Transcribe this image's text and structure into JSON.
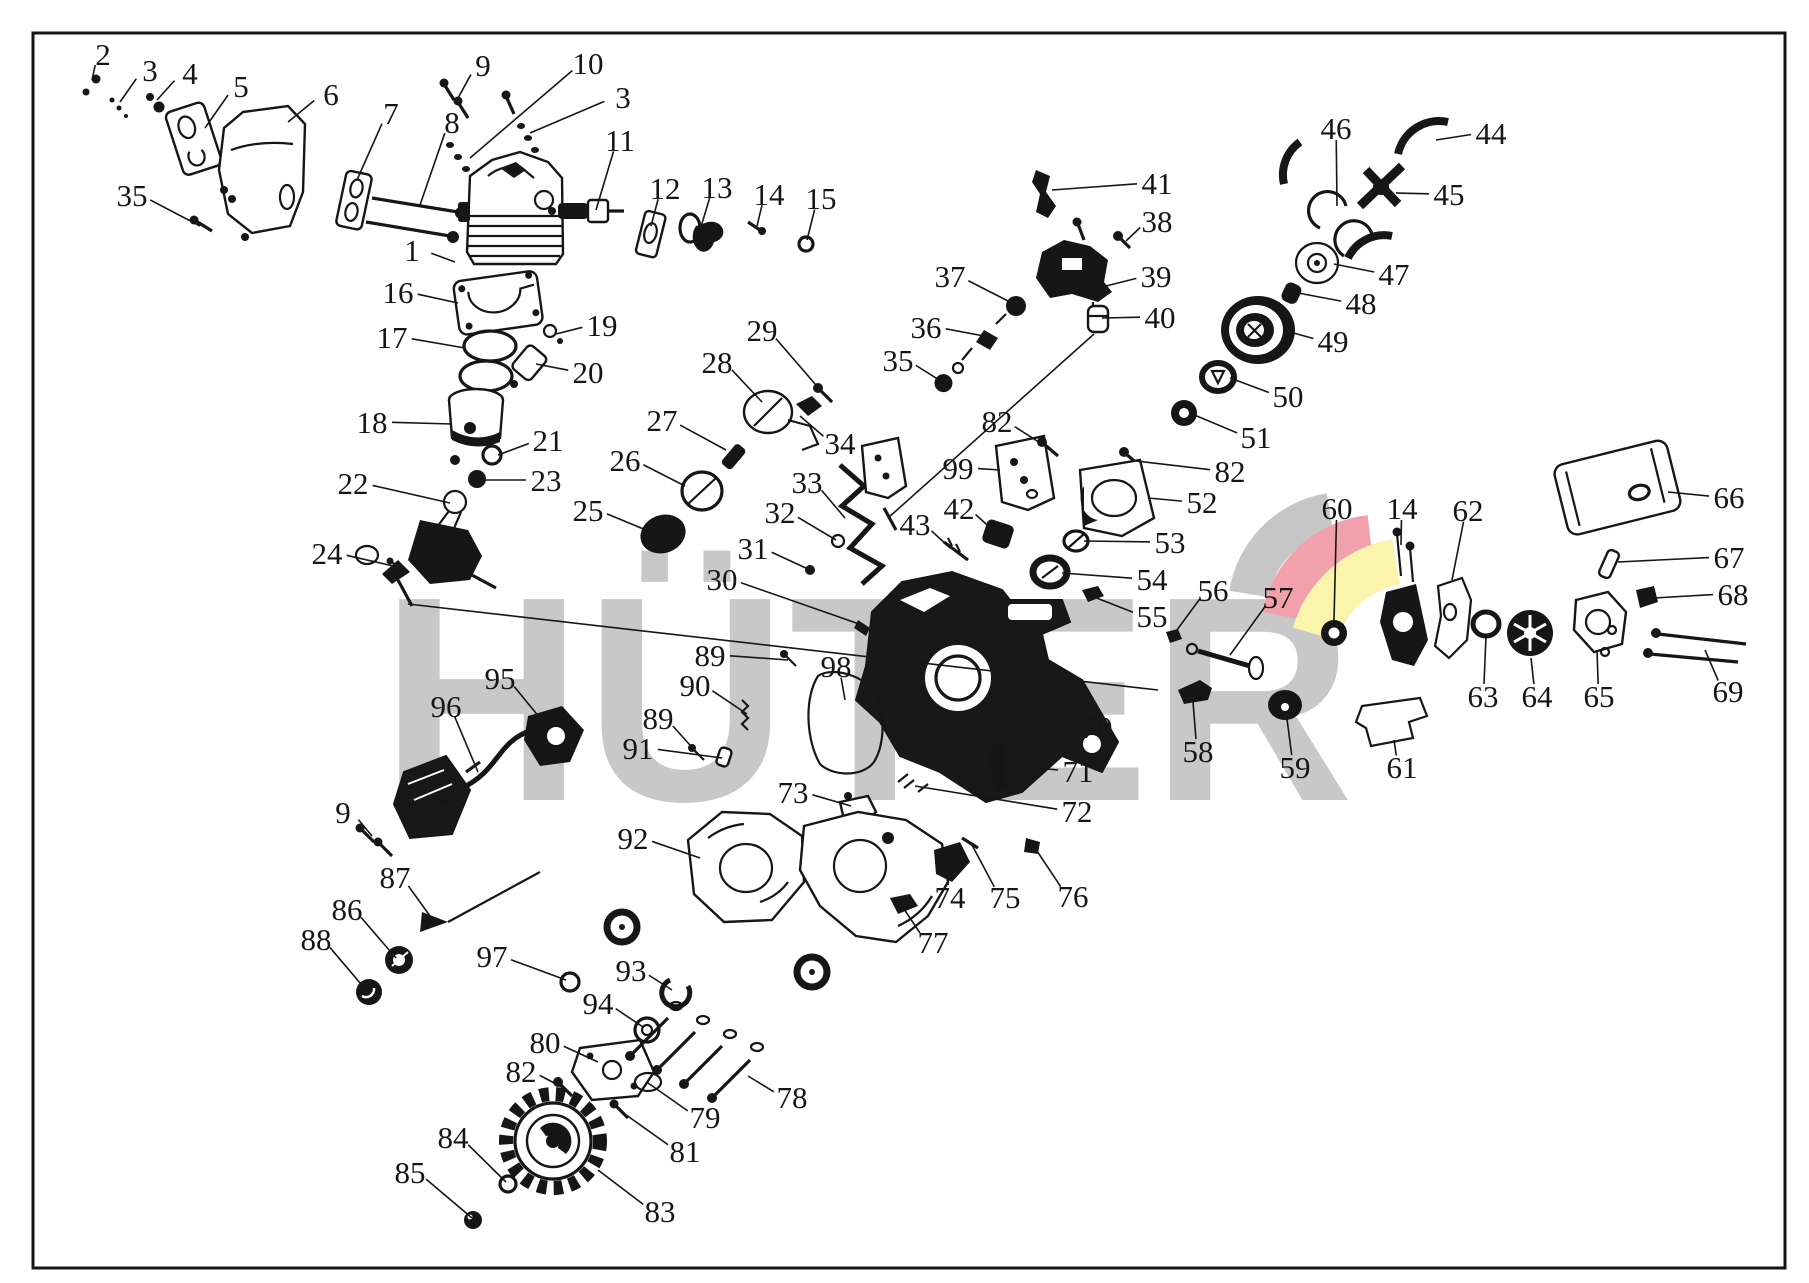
{
  "title": "chainsaw-exploded-parts-diagram",
  "watermark": {
    "text": "HÜTER"
  },
  "colors": {
    "ink": "#161616",
    "watermark_gray": "#c8c8c8",
    "logo_gray": "#c6c6c6",
    "logo_pink": "#f2a0ac",
    "logo_yellow": "#faf4ac",
    "background": "#ffffff"
  },
  "callouts": [
    {
      "n": "2",
      "x": 103,
      "y": 54,
      "tx": 92,
      "ty": 80
    },
    {
      "n": "3",
      "x": 150,
      "y": 70,
      "tx": 120,
      "ty": 102
    },
    {
      "n": "4",
      "x": 190,
      "y": 73,
      "tx": 157,
      "ty": 100
    },
    {
      "n": "5",
      "x": 241,
      "y": 86,
      "tx": 205,
      "ty": 128
    },
    {
      "n": "6",
      "x": 331,
      "y": 94,
      "tx": 288,
      "ty": 122
    },
    {
      "n": "7",
      "x": 391,
      "y": 113,
      "tx": 357,
      "ty": 180
    },
    {
      "n": "8",
      "x": 452,
      "y": 122,
      "tx": 420,
      "ty": 205
    },
    {
      "n": "9",
      "x": 483,
      "y": 65,
      "tx": 458,
      "ty": 98
    },
    {
      "n": "10",
      "x": 588,
      "y": 63,
      "tx": 470,
      "ty": 158
    },
    {
      "n": "3",
      "x": 623,
      "y": 97,
      "tx": 530,
      "ty": 133
    },
    {
      "n": "11",
      "x": 620,
      "y": 140,
      "tx": 596,
      "ty": 210
    },
    {
      "n": "35",
      "x": 132,
      "y": 195,
      "tx": 200,
      "ty": 226
    },
    {
      "n": "12",
      "x": 665,
      "y": 188,
      "tx": 651,
      "ty": 226
    },
    {
      "n": "13",
      "x": 717,
      "y": 187,
      "tx": 700,
      "ty": 230
    },
    {
      "n": "14",
      "x": 769,
      "y": 194,
      "tx": 757,
      "ty": 226
    },
    {
      "n": "15",
      "x": 821,
      "y": 198,
      "tx": 807,
      "ty": 240
    },
    {
      "n": "1",
      "x": 412,
      "y": 250,
      "tx": 455,
      "ty": 262
    },
    {
      "n": "16",
      "x": 398,
      "y": 292,
      "tx": 458,
      "ty": 303
    },
    {
      "n": "17",
      "x": 392,
      "y": 337,
      "tx": 465,
      "ty": 348
    },
    {
      "n": "19",
      "x": 602,
      "y": 325,
      "tx": 556,
      "ty": 334
    },
    {
      "n": "20",
      "x": 588,
      "y": 372,
      "tx": 536,
      "ty": 364
    },
    {
      "n": "18",
      "x": 372,
      "y": 422,
      "tx": 452,
      "ty": 424
    },
    {
      "n": "21",
      "x": 548,
      "y": 440,
      "tx": 498,
      "ty": 455
    },
    {
      "n": "23",
      "x": 546,
      "y": 480,
      "tx": 482,
      "ty": 480
    },
    {
      "n": "22",
      "x": 353,
      "y": 483,
      "tx": 450,
      "ty": 503
    },
    {
      "n": "24",
      "x": 327,
      "y": 553,
      "tx": 393,
      "ty": 566
    },
    {
      "n": "25",
      "x": 588,
      "y": 510,
      "tx": 646,
      "ty": 530
    },
    {
      "n": "26",
      "x": 625,
      "y": 460,
      "tx": 685,
      "ty": 486
    },
    {
      "n": "27",
      "x": 662,
      "y": 420,
      "tx": 726,
      "ty": 450
    },
    {
      "n": "28",
      "x": 717,
      "y": 362,
      "tx": 762,
      "ty": 402
    },
    {
      "n": "29",
      "x": 762,
      "y": 330,
      "tx": 822,
      "ty": 392
    },
    {
      "n": "30",
      "x": 722,
      "y": 579,
      "tx": 862,
      "ty": 625
    },
    {
      "n": "31",
      "x": 753,
      "y": 548,
      "tx": 808,
      "ty": 569
    },
    {
      "n": "32",
      "x": 780,
      "y": 512,
      "tx": 836,
      "ty": 540
    },
    {
      "n": "33",
      "x": 807,
      "y": 482,
      "tx": 845,
      "ty": 518
    },
    {
      "n": "34",
      "x": 840,
      "y": 443,
      "tx": 800,
      "ty": 416
    },
    {
      "n": "41",
      "x": 1157,
      "y": 183,
      "tx": 1052,
      "ty": 190
    },
    {
      "n": "38",
      "x": 1157,
      "y": 221,
      "tx": 1126,
      "ty": 241
    },
    {
      "n": "39",
      "x": 1156,
      "y": 276,
      "tx": 1106,
      "ty": 286
    },
    {
      "n": "40",
      "x": 1160,
      "y": 317,
      "tx": 1102,
      "ty": 318
    },
    {
      "n": "37",
      "x": 950,
      "y": 276,
      "tx": 1010,
      "ty": 302
    },
    {
      "n": "36",
      "x": 926,
      "y": 327,
      "tx": 984,
      "ty": 336
    },
    {
      "n": "35",
      "x": 898,
      "y": 360,
      "tx": 944,
      "ty": 383
    },
    {
      "n": "82",
      "x": 997,
      "y": 421,
      "tx": 1048,
      "ty": 448
    },
    {
      "n": "99",
      "x": 958,
      "y": 468,
      "tx": 1000,
      "ty": 470
    },
    {
      "n": "42",
      "x": 959,
      "y": 508,
      "tx": 995,
      "ty": 532
    },
    {
      "n": "43",
      "x": 915,
      "y": 524,
      "tx": 950,
      "ty": 548
    },
    {
      "n": "46",
      "x": 1336,
      "y": 128,
      "tx": 1337,
      "ty": 206
    },
    {
      "n": "44",
      "x": 1491,
      "y": 133,
      "tx": 1436,
      "ty": 140
    },
    {
      "n": "45",
      "x": 1449,
      "y": 194,
      "tx": 1396,
      "ty": 193
    },
    {
      "n": "47",
      "x": 1394,
      "y": 274,
      "tx": 1334,
      "ty": 264
    },
    {
      "n": "48",
      "x": 1361,
      "y": 303,
      "tx": 1298,
      "ty": 293
    },
    {
      "n": "49",
      "x": 1333,
      "y": 341,
      "tx": 1290,
      "ty": 332
    },
    {
      "n": "50",
      "x": 1288,
      "y": 396,
      "tx": 1230,
      "ty": 378
    },
    {
      "n": "51",
      "x": 1256,
      "y": 437,
      "tx": 1192,
      "ty": 414
    },
    {
      "n": "82",
      "x": 1230,
      "y": 471,
      "tx": 1136,
      "ty": 461
    },
    {
      "n": "52",
      "x": 1202,
      "y": 502,
      "tx": 1148,
      "ty": 498
    },
    {
      "n": "53",
      "x": 1170,
      "y": 542,
      "tx": 1084,
      "ty": 541
    },
    {
      "n": "54",
      "x": 1152,
      "y": 579,
      "tx": 1062,
      "ty": 573
    },
    {
      "n": "55",
      "x": 1152,
      "y": 616,
      "tx": 1094,
      "ty": 597
    },
    {
      "n": "56",
      "x": 1213,
      "y": 590,
      "tx": 1174,
      "ty": 634
    },
    {
      "n": "57",
      "x": 1278,
      "y": 597,
      "tx": 1230,
      "ty": 655
    },
    {
      "n": "60",
      "x": 1337,
      "y": 508,
      "tx": 1334,
      "ty": 620
    },
    {
      "n": "14",
      "x": 1402,
      "y": 508,
      "tx": 1401,
      "ty": 545
    },
    {
      "n": "62",
      "x": 1468,
      "y": 510,
      "tx": 1452,
      "ty": 580
    },
    {
      "n": "66",
      "x": 1729,
      "y": 497,
      "tx": 1668,
      "ty": 492
    },
    {
      "n": "67",
      "x": 1729,
      "y": 557,
      "tx": 1618,
      "ty": 562
    },
    {
      "n": "68",
      "x": 1733,
      "y": 594,
      "tx": 1654,
      "ty": 598
    },
    {
      "n": "69",
      "x": 1728,
      "y": 691,
      "tx": 1705,
      "ty": 650
    },
    {
      "n": "63",
      "x": 1483,
      "y": 696,
      "tx": 1486,
      "ty": 636
    },
    {
      "n": "64",
      "x": 1537,
      "y": 696,
      "tx": 1531,
      "ty": 658
    },
    {
      "n": "65",
      "x": 1599,
      "y": 696,
      "tx": 1597,
      "ty": 650
    },
    {
      "n": "61",
      "x": 1402,
      "y": 767,
      "tx": 1394,
      "ty": 740
    },
    {
      "n": "58",
      "x": 1198,
      "y": 751,
      "tx": 1193,
      "ty": 702
    },
    {
      "n": "59",
      "x": 1295,
      "y": 767,
      "tx": 1287,
      "ty": 719
    },
    {
      "n": "70",
      "x": 1097,
      "y": 727,
      "tx": 1018,
      "ty": 688
    },
    {
      "n": "71",
      "x": 1078,
      "y": 771,
      "tx": 1007,
      "ty": 765
    },
    {
      "n": "72",
      "x": 1077,
      "y": 811,
      "tx": 915,
      "ty": 786
    },
    {
      "n": "73",
      "x": 793,
      "y": 792,
      "tx": 851,
      "ty": 806
    },
    {
      "n": "74",
      "x": 950,
      "y": 897,
      "tx": 947,
      "ty": 864
    },
    {
      "n": "75",
      "x": 1005,
      "y": 897,
      "tx": 972,
      "ty": 845
    },
    {
      "n": "76",
      "x": 1073,
      "y": 896,
      "tx": 1033,
      "ty": 845
    },
    {
      "n": "77",
      "x": 933,
      "y": 942,
      "tx": 902,
      "ty": 906
    },
    {
      "n": "89",
      "x": 710,
      "y": 655,
      "tx": 788,
      "ty": 660
    },
    {
      "n": "90",
      "x": 695,
      "y": 685,
      "tx": 747,
      "ty": 714
    },
    {
      "n": "89",
      "x": 658,
      "y": 718,
      "tx": 698,
      "ty": 754
    },
    {
      "n": "91",
      "x": 638,
      "y": 748,
      "tx": 722,
      "ty": 758
    },
    {
      "n": "98",
      "x": 836,
      "y": 666,
      "tx": 845,
      "ty": 700
    },
    {
      "n": "95",
      "x": 500,
      "y": 678,
      "tx": 540,
      "ty": 718
    },
    {
      "n": "96",
      "x": 446,
      "y": 706,
      "tx": 478,
      "ty": 772
    },
    {
      "n": "9",
      "x": 343,
      "y": 812,
      "tx": 372,
      "ty": 836
    },
    {
      "n": "92",
      "x": 633,
      "y": 838,
      "tx": 700,
      "ty": 858
    },
    {
      "n": "87",
      "x": 395,
      "y": 877,
      "tx": 430,
      "ty": 916
    },
    {
      "n": "86",
      "x": 347,
      "y": 909,
      "tx": 396,
      "ty": 958
    },
    {
      "n": "88",
      "x": 316,
      "y": 939,
      "tx": 366,
      "ty": 990
    },
    {
      "n": "97",
      "x": 492,
      "y": 956,
      "tx": 566,
      "ty": 980
    },
    {
      "n": "93",
      "x": 631,
      "y": 970,
      "tx": 672,
      "ty": 990
    },
    {
      "n": "94",
      "x": 598,
      "y": 1003,
      "tx": 643,
      "ty": 1027
    },
    {
      "n": "80",
      "x": 545,
      "y": 1042,
      "tx": 598,
      "ty": 1062
    },
    {
      "n": "82",
      "x": 521,
      "y": 1071,
      "tx": 562,
      "ty": 1087
    },
    {
      "n": "79",
      "x": 705,
      "y": 1117,
      "tx": 648,
      "ty": 1083
    },
    {
      "n": "81",
      "x": 685,
      "y": 1151,
      "tx": 622,
      "ty": 1112
    },
    {
      "n": "78",
      "x": 792,
      "y": 1097,
      "tx": 748,
      "ty": 1076
    },
    {
      "n": "84",
      "x": 453,
      "y": 1137,
      "tx": 506,
      "ty": 1182
    },
    {
      "n": "85",
      "x": 410,
      "y": 1172,
      "tx": 472,
      "ty": 1218
    },
    {
      "n": "83",
      "x": 660,
      "y": 1211,
      "tx": 598,
      "ty": 1170
    }
  ]
}
